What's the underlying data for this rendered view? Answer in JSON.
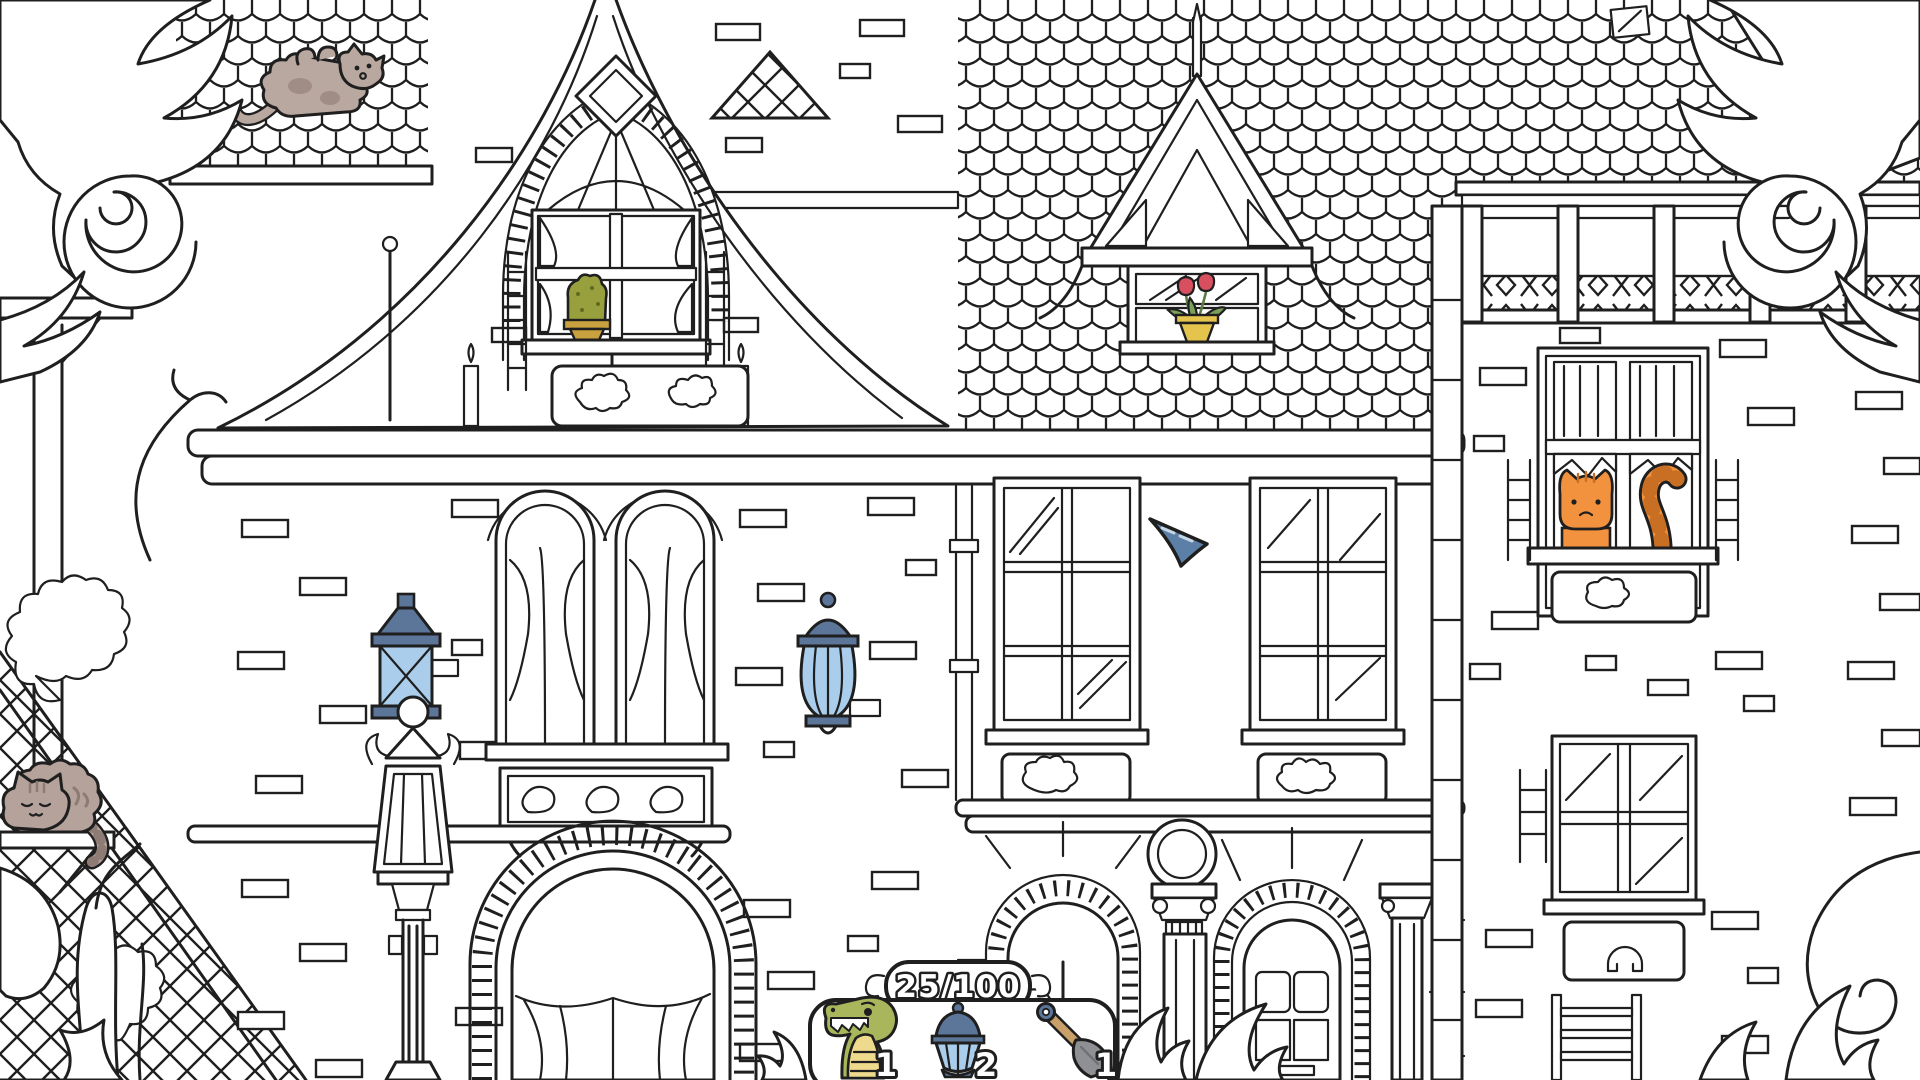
{
  "hud": {
    "counter": {
      "label": "25/100"
    },
    "items": [
      {
        "icon": "crocodile-icon",
        "count": "1"
      },
      {
        "icon": "lantern-icon",
        "count": "2"
      },
      {
        "icon": "shovel-icon",
        "count": "1"
      }
    ]
  },
  "scene": {
    "hidden_objects": [
      {
        "name": "cat-on-roof"
      },
      {
        "name": "sleeping-cat-on-shelf"
      },
      {
        "name": "orange-cat-in-window"
      },
      {
        "name": "wall-lantern-left"
      },
      {
        "name": "wall-lantern-center"
      },
      {
        "name": "cactus-in-window"
      },
      {
        "name": "tulips-in-window"
      }
    ],
    "colors": {
      "line": "#1f1f1f",
      "lantern_frame": "#5c7699",
      "lantern_glass": "#a9cdea",
      "cat_orange": "#f2923f",
      "cat_orange_dark": "#c96f24",
      "cat_gray": "#b4a29b",
      "croc_green": "#a9b65c",
      "croc_belly": "#eeda8c",
      "cactus_green": "#97a03c",
      "pot_yellow": "#e4c44d",
      "tulip_red": "#d84f60",
      "leaf_green": "#7ba05b",
      "cursor_blue": "#5b7fa6",
      "shovel_gray": "#8e9094",
      "handle_brown": "#c9a06a"
    }
  }
}
